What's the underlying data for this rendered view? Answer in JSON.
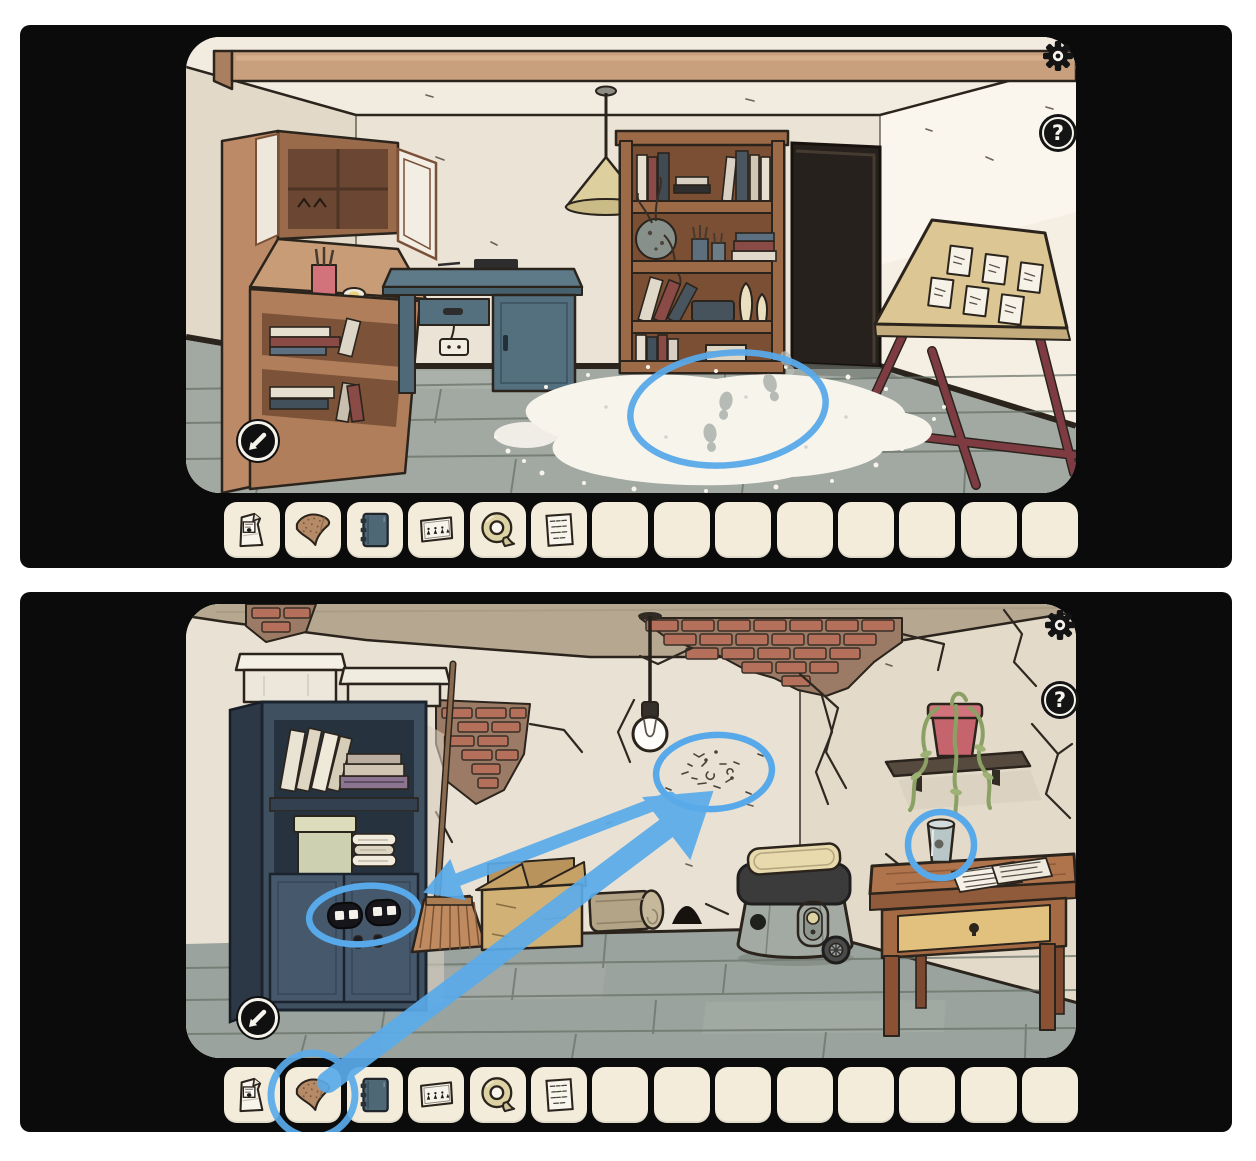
{
  "ui": {
    "help_label": "?",
    "highlight_color": "#58a9e9",
    "panel_color": "#0b0b0b",
    "slot_color": "#f3ecdb"
  },
  "inventory": {
    "slot_count": 14,
    "items": [
      {
        "slot": 1,
        "name": "flour-bag"
      },
      {
        "slot": 2,
        "name": "sandpaper"
      },
      {
        "slot": 3,
        "name": "blue-notebook"
      },
      {
        "slot": 4,
        "name": "figures-card"
      },
      {
        "slot": 5,
        "name": "tape-roll"
      },
      {
        "slot": 6,
        "name": "note-paper"
      }
    ]
  },
  "panels": [
    {
      "name": "studio-room",
      "objects": [
        "wooden-hutch",
        "blue-desk",
        "power-outlet",
        "bookshelf",
        "dark-doorway",
        "drafting-board-with-cards",
        "hanging-lamp",
        "ceiling-beam",
        "flour-pile-with-footprints"
      ],
      "annotations": [
        {
          "shape": "ellipse",
          "target": "footprints-in-flour"
        }
      ]
    },
    {
      "name": "basement-room",
      "objects": [
        "storage-cabinet",
        "white-boxes",
        "books",
        "green-box",
        "folded-towels",
        "button-lock",
        "broom",
        "cardboard-box",
        "rolled-mat",
        "mouse-hole",
        "vacuum-cleaner",
        "wooden-table",
        "drawer-keyhole",
        "glass-cup",
        "papers",
        "wall-shelf",
        "hanging-plant",
        "light-bulb",
        "wall-scratches",
        "exposed-bricks",
        "wall-cracks"
      ],
      "annotations": [
        {
          "shape": "ellipse",
          "target": "wall-scratches"
        },
        {
          "shape": "ellipse",
          "target": "cabinet-button-lock"
        },
        {
          "shape": "circle",
          "target": "cup-on-table"
        },
        {
          "shape": "circle",
          "target": "inventory-sandpaper"
        },
        {
          "shape": "arrow",
          "from": "inventory-sandpaper",
          "to": "wall-scratches"
        },
        {
          "shape": "arrow",
          "from": "wall-scratches",
          "to": "cabinet-button-lock"
        }
      ]
    }
  ]
}
